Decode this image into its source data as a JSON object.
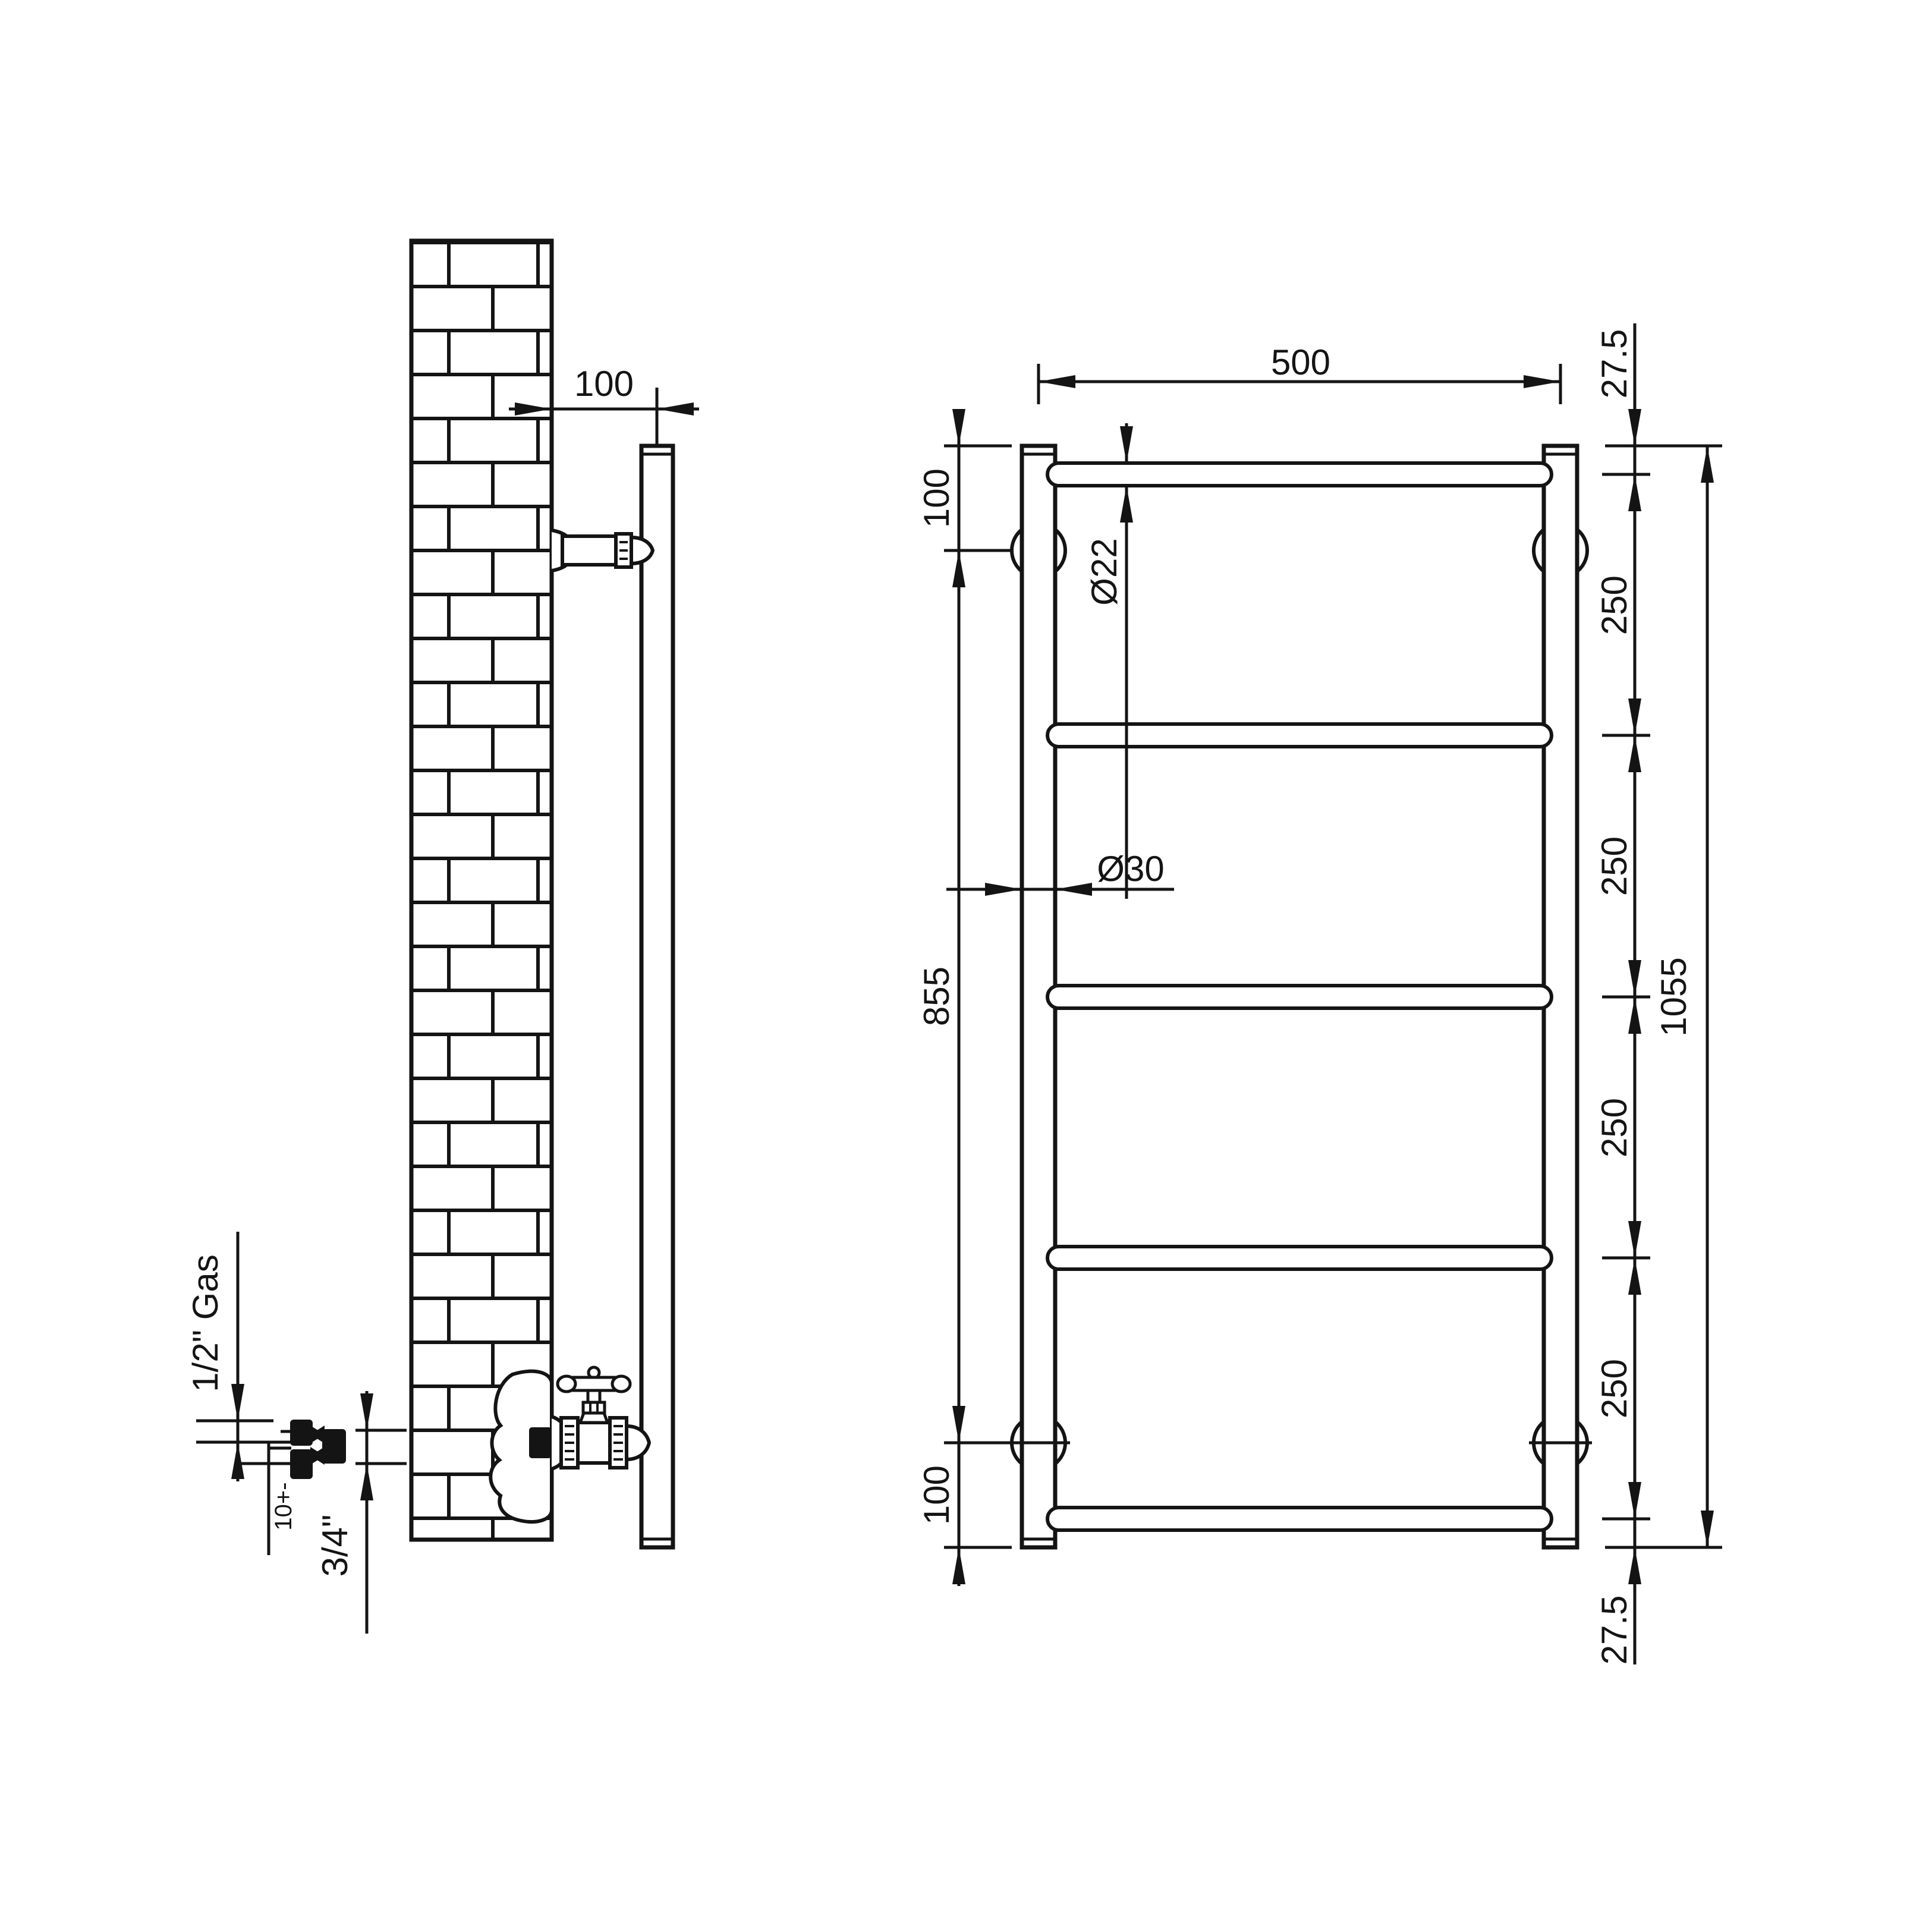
{
  "page": {
    "background": "#ffffff",
    "ink": "#141414",
    "kind": "technical installation drawing",
    "subject": "ladder towel radiator - wall side view and front elevation"
  },
  "side_view": {
    "wall": "brick wall section",
    "labels": {
      "wall_to_center": "100",
      "inlet_size": "1/2\" Gas",
      "center_tolerance": "10+-",
      "outlet_size": "3/4\""
    }
  },
  "front_view": {
    "rails_count": 5,
    "labels": {
      "width": "500",
      "top_end_offset": "27.5",
      "rail_spacing": "250",
      "overall_height": "1055",
      "bottom_end_offset": "27.5",
      "bracket_from_top": "100",
      "bracket_span": "855",
      "bracket_from_bottom": "100",
      "rail_diameter": "Ø22",
      "upright_diameter": "Ø30"
    }
  }
}
